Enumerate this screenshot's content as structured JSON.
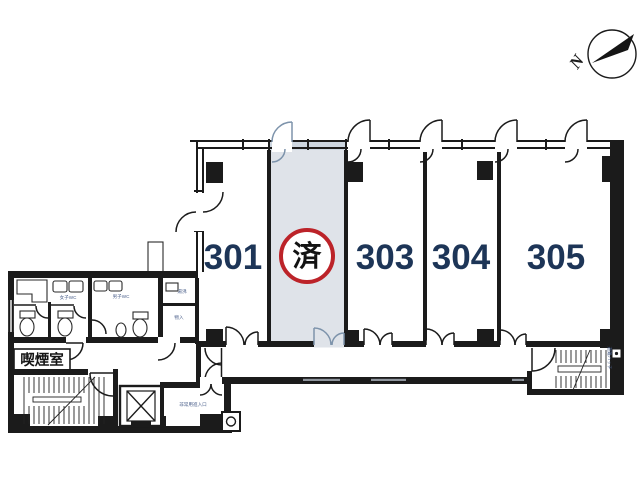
{
  "compass": {
    "north_label": "N"
  },
  "rooms": {
    "r301": {
      "label": "301"
    },
    "r302": {
      "label": "済"
    },
    "r303": {
      "label": "303"
    },
    "r304": {
      "label": "304"
    },
    "r305": {
      "label": "305"
    }
  },
  "annotations": {
    "smoking_room": "喫煙室",
    "womens_wc": "女子WC",
    "mens_wc": "男子WC",
    "kitchenette": "湯沸",
    "storage": "物入",
    "hall_note": "非常用進入口",
    "evac_hatch": "避難ハッチ"
  },
  "colors": {
    "wall": "#1b1b1b",
    "room_number": "#1d3557",
    "sold_circle": "#bc2329",
    "shade": "#dfe3e9",
    "shade_window": "#ccd5df",
    "door_accent": "#7d93ab",
    "annotation": "#4a5f8a",
    "paper": "#ffffff"
  }
}
